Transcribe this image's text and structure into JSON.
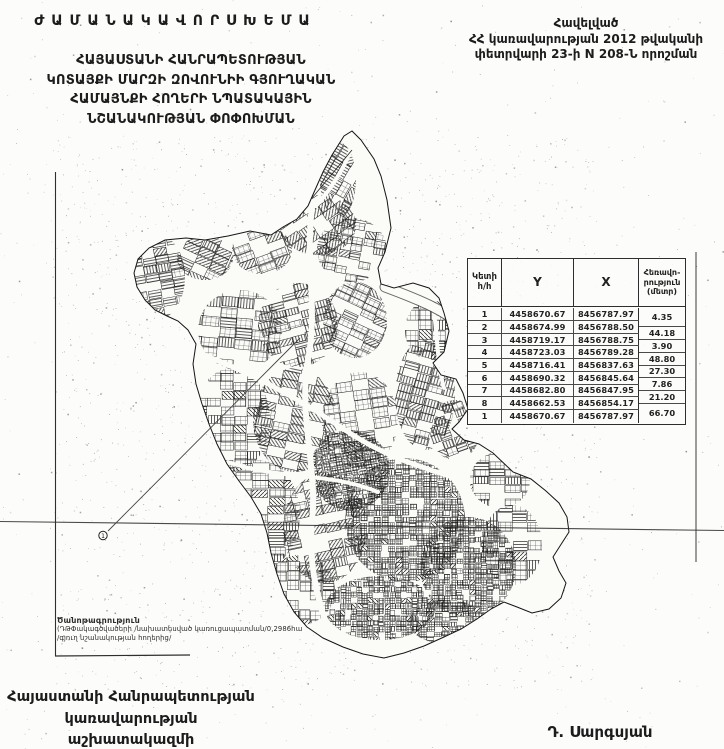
{
  "colors": {
    "ink": "#1c1c1c",
    "paper": "#fcfcfa",
    "line": "#2e2e2e"
  },
  "title_block": {
    "line1": "Ժ Ա Մ Ա Ն Ա Կ Ա Վ Ո Ր   Ս Խ Ե Մ Ա",
    "line2": "ՀԱՅԱՍՏԱՆԻ ՀԱՆՐԱՊԵՏՈՒԹՅԱՆ",
    "line3": "ԿՈՏԱՅՔԻ ՄԱՐԶԻ ԶՈՎՈՒՆԻԻ ԳՅՈՒՂԱԿԱՆ",
    "line4": "ՀԱՄԱՅՆՔԻ ՀՈՂԵՐԻ ՆՊԱՏԱԿԱՅԻՆ",
    "line5": "ՆՇԱՆԱԿՈՒԹՅԱՆ ՓՈՓՈԽՄԱՆ"
  },
  "approval_block": {
    "line1": "Հավելված",
    "line2": "ՀՀ կառավարության 2012 թվականի",
    "line3": "փետրվարի 23-ի N 208-Ն որոշման"
  },
  "coordinate_table": {
    "header": {
      "point_line1": "Կետի",
      "point_line2": "հ/հ",
      "y": "Y",
      "x": "X",
      "dist_line1": "Հեռավո-",
      "dist_line2": "րություն",
      "dist_line3": "(մետր)"
    },
    "rows": [
      {
        "point": "1",
        "y": "4458670.67",
        "x": "8456787.97"
      },
      {
        "point": "2",
        "y": "4458674.99",
        "x": "8456788.50"
      },
      {
        "point": "3",
        "y": "4458719.17",
        "x": "8456788.75"
      },
      {
        "point": "4",
        "y": "4458723.03",
        "x": "8456789.28"
      },
      {
        "point": "5",
        "y": "4458716.41",
        "x": "8456837.63"
      },
      {
        "point": "6",
        "y": "4458690.32",
        "x": "8456845.64"
      },
      {
        "point": "7",
        "y": "4458682.80",
        "x": "8456847.95"
      },
      {
        "point": "8",
        "y": "4458662.53",
        "x": "8456854.17"
      },
      {
        "point": "1",
        "y": "4458670.67",
        "x": "8456787.97"
      }
    ],
    "distances": [
      "4.35",
      "44.18",
      "3.90",
      "48.80",
      "27.30",
      "7.86",
      "21.20",
      "66.70"
    ]
  },
  "map": {
    "marker_label": "1",
    "note_line1": "Ծանոթագրություն",
    "note_line2": "(ԴԹՓակագծվածերի /նախատեսված կառուցապատման/0,2986հա",
    "note_line3": "/գյուղ նշանակության հողերից/"
  },
  "footer": {
    "left_line1": "Հայաստանի Հանրապետության",
    "left_line2": "կառավարության աշխատակազմի",
    "left_line3": "ղեկավար",
    "signature": "Դ. Սարգսյան"
  }
}
